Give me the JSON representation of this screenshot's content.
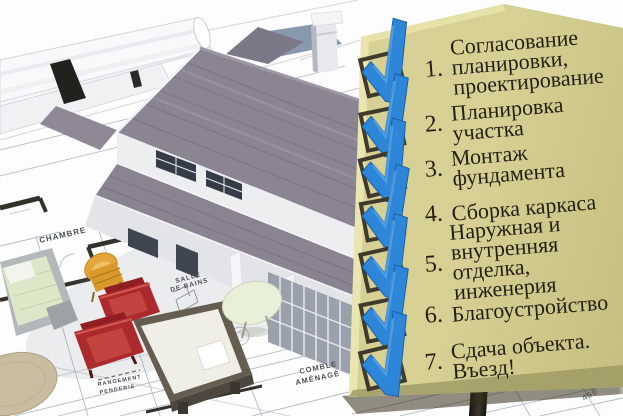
{
  "checklist": {
    "items": [
      {
        "number": "1.",
        "lines": [
          "Согласование",
          "планировки,",
          "проектирование"
        ]
      },
      {
        "number": "2.",
        "lines": [
          "Планировка",
          "участка"
        ]
      },
      {
        "number": "3.",
        "lines": [
          "Монтаж",
          "фундамента"
        ]
      },
      {
        "number": "4.",
        "lines": [
          "Сборка каркаса"
        ]
      },
      {
        "number": "5.",
        "lines": [
          "Наружная и",
          "внутренняя",
          "отделка,",
          "инженерия"
        ]
      },
      {
        "number": "6.",
        "lines": [
          "Благоустройство"
        ]
      },
      {
        "number": "7.",
        "lines": [
          "Сдача объекта.",
          "Въезд!"
        ]
      }
    ],
    "colors": {
      "panel": "#d5cf93",
      "checkmark": "#2e86d8",
      "checkbox_border": "#3f3a2b",
      "text": "#241f15"
    }
  },
  "blueprint": {
    "labels": {
      "chambre": "CHAMBRE",
      "salle_line1": "SALLE",
      "salle_line2": "DE BAINS",
      "comble_line1": "COMBLE",
      "comble_line2": "AMÉNAGÉ",
      "rangement_line1": "RANGEMENT",
      "rangement_line2": "PENDERIE",
      "dimension": "450"
    },
    "colors": {
      "roof": "#8a8492",
      "chair_red": "#ad2a2c",
      "chair_yellow": "#e3a63c",
      "plan_line": "#9aa6b2"
    }
  }
}
